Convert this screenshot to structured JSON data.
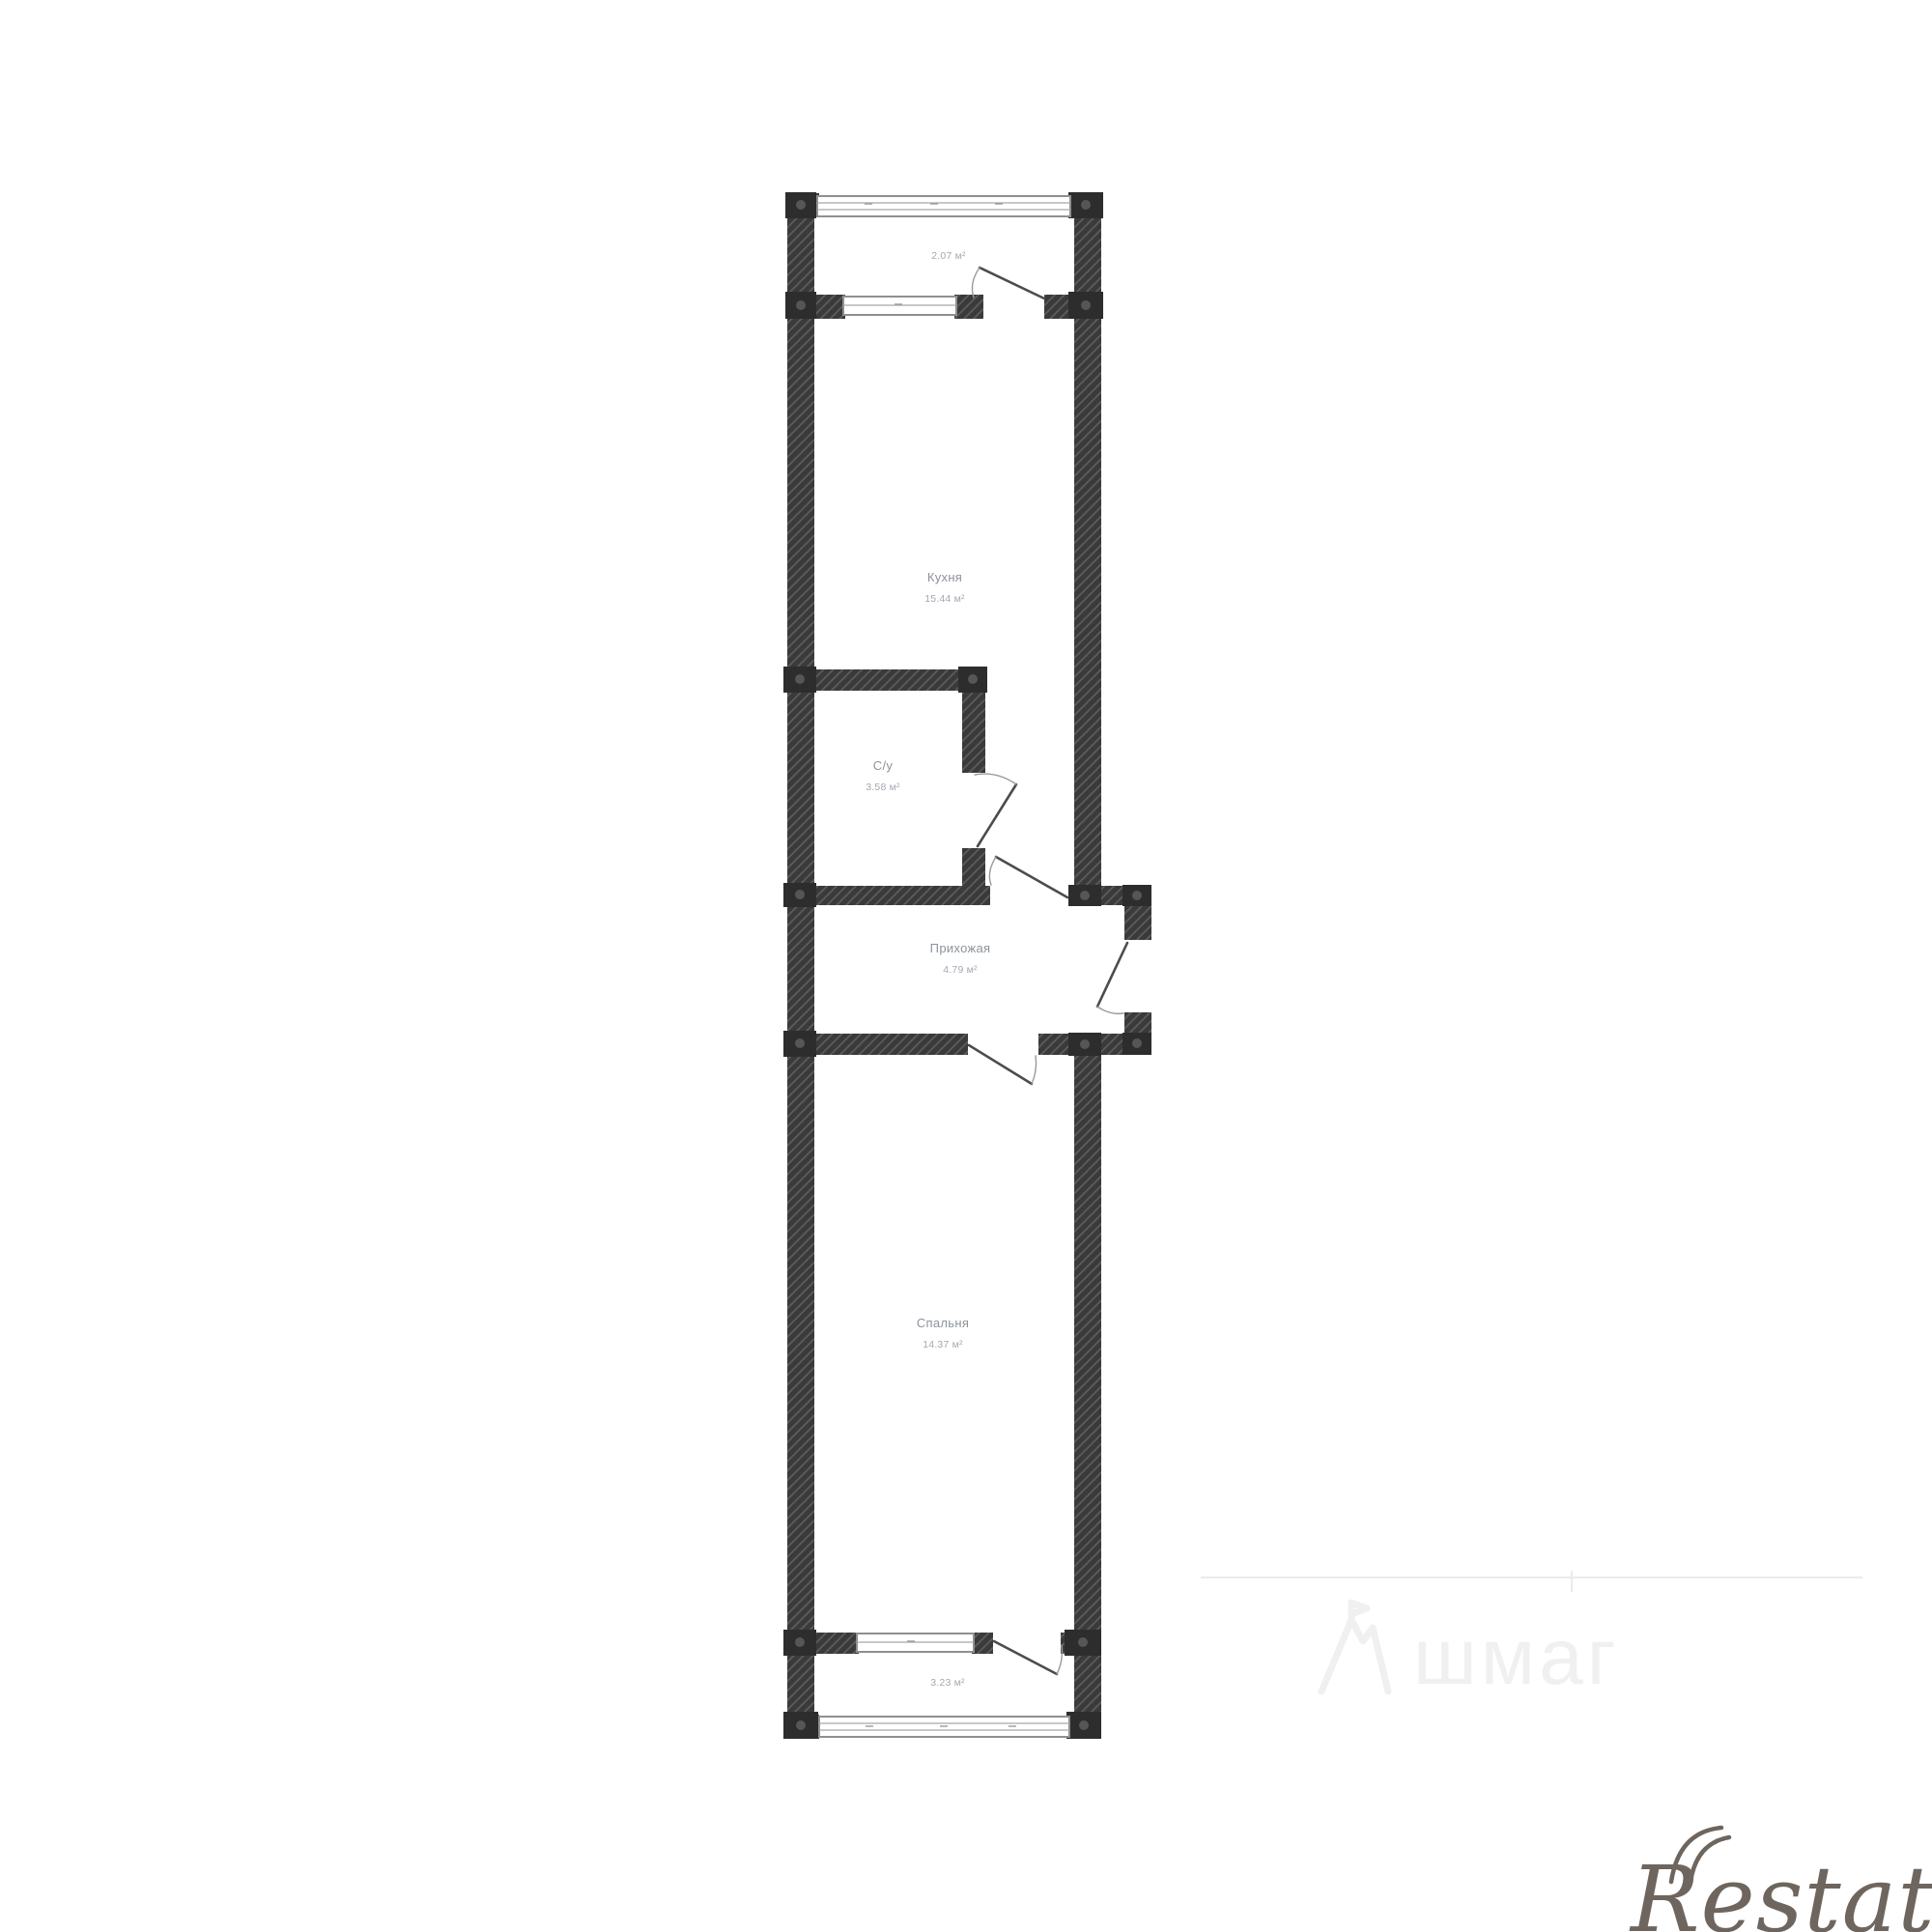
{
  "rooms": {
    "balcony_top": {
      "area": "2.07 м²"
    },
    "kitchen": {
      "name": "Кухня",
      "area": "15.44 м²"
    },
    "bathroom": {
      "name": "С/у",
      "area": "3.58 м²"
    },
    "hallway": {
      "name": "Прихожая",
      "area": "4.79 м²"
    },
    "bedroom": {
      "name": "Спальня",
      "area": "14.37 м²"
    },
    "balcony_bottom": {
      "area": "3.23 м²"
    }
  },
  "watermarks": {
    "center_text": "шмаг",
    "brand": "Restate"
  },
  "colors": {
    "wall_fill": "#3a3a3a",
    "wall_hatch": "#5c5c5c",
    "joint_fill": "#2d2d2d",
    "window_line": "#8f8f8f",
    "door_line": "#4c4c4c",
    "label_name_text": "#8d939a",
    "label_area_text": "#a3a9b0",
    "brand_text": "#6e665e",
    "center_watermark_text": "#f0f0f0"
  }
}
